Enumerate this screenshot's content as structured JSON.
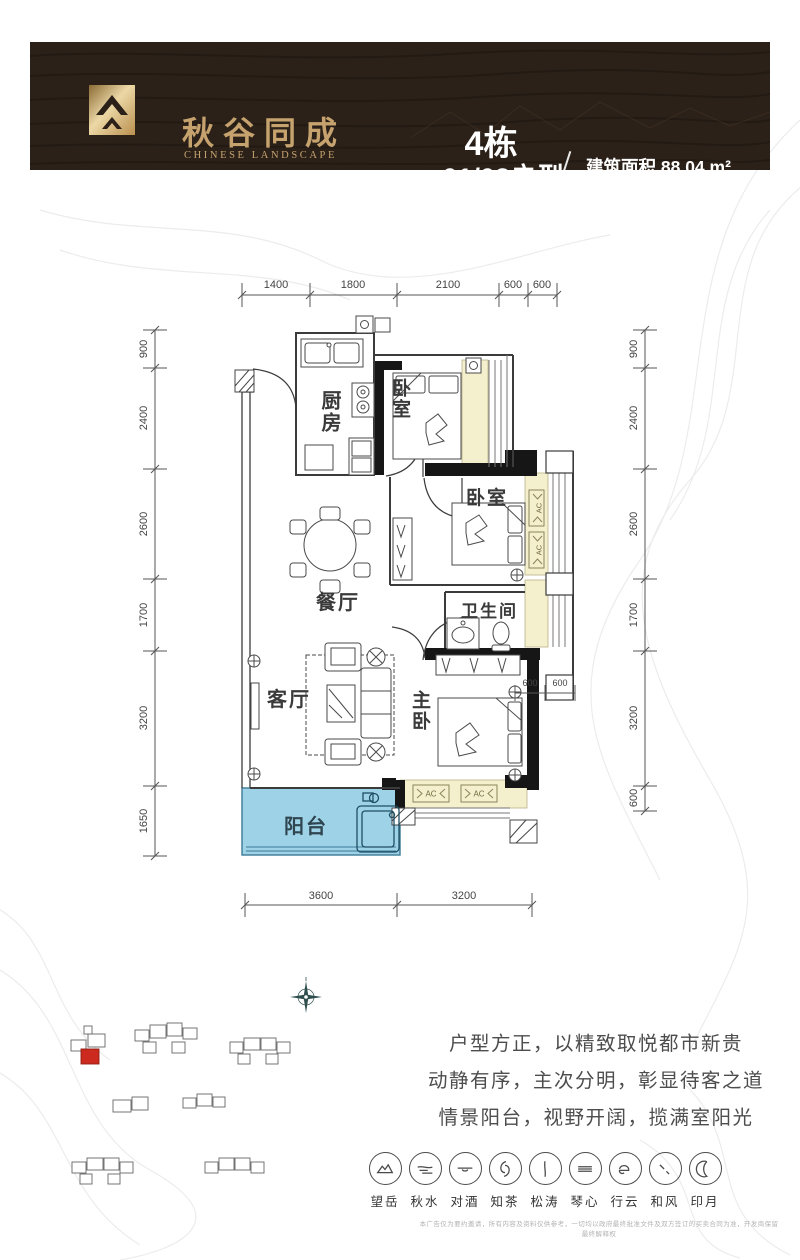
{
  "header": {
    "brand_cn": "秋谷同成",
    "brand_en": "CHINESE LANDSCAPE",
    "building": "4栋",
    "unit": "01/02户型",
    "area_label": "建筑面积 88.04 m²",
    "layout_label": "三房两厅一卫"
  },
  "plan": {
    "rooms": {
      "kitchen": "厨房",
      "bedroom1": "卧室",
      "bedroom2": "卧室",
      "dining": "餐厅",
      "bathroom": "卫生间",
      "living": "客厅",
      "master": "主卧",
      "balcony": "阳台"
    },
    "ac": "AC",
    "dims": {
      "top": [
        "1400",
        "1800",
        "2100",
        "600",
        "600"
      ],
      "left": [
        "900",
        "2400",
        "2600",
        "1700",
        "3200",
        "1650"
      ],
      "right": [
        "900",
        "2400",
        "2600",
        "1700",
        "3200",
        "600"
      ],
      "bottom": [
        "3600",
        "3200"
      ],
      "inner": [
        "600",
        "600"
      ]
    }
  },
  "description": {
    "line1": "户型方正，以精致取悦都市新贵",
    "line2": "动静有序，主次分明，彰显待客之道",
    "line3": "情景阳台，视野开阔，揽满室阳光"
  },
  "features": [
    {
      "label": "望岳",
      "icon": "mountain"
    },
    {
      "label": "秋水",
      "icon": "water"
    },
    {
      "label": "对酒",
      "icon": "wine"
    },
    {
      "label": "知茶",
      "icon": "tea"
    },
    {
      "label": "松涛",
      "icon": "pine"
    },
    {
      "label": "琴心",
      "icon": "zither"
    },
    {
      "label": "行云",
      "icon": "cloud"
    },
    {
      "label": "和风",
      "icon": "wind"
    },
    {
      "label": "印月",
      "icon": "moon"
    }
  ],
  "disclaimer": "本广告仅为要约邀请，所有内容及资料仅供参考，一切均以政府最终批准文件及双方签订的买卖合同为准，开发商保留最终解释权",
  "colors": {
    "header_bg": "#2b2119",
    "gold": "#c6a36e",
    "balcony_blue": "#9ed2e7",
    "bay_yellow": "#f4efcd",
    "highlight_red": "#cc2a1e"
  }
}
